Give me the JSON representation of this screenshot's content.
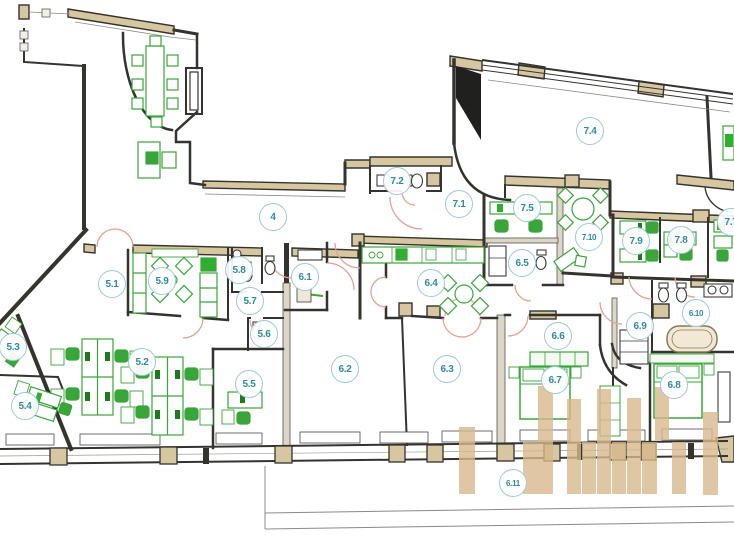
{
  "plan": {
    "kind": "architectural floor plan",
    "room_labels": [
      {
        "label": "4",
        "x": 273,
        "y": 217
      },
      {
        "label": "5.1",
        "x": 112,
        "y": 284
      },
      {
        "label": "5.2",
        "x": 142,
        "y": 362
      },
      {
        "label": "5.3",
        "x": 13,
        "y": 347
      },
      {
        "label": "5.4",
        "x": 25,
        "y": 406
      },
      {
        "label": "5.5",
        "x": 249,
        "y": 384
      },
      {
        "label": "5.6",
        "x": 264,
        "y": 334
      },
      {
        "label": "5.7",
        "x": 250,
        "y": 301
      },
      {
        "label": "5.8",
        "x": 239,
        "y": 270
      },
      {
        "label": "5.9",
        "x": 162,
        "y": 281
      },
      {
        "label": "6.1",
        "x": 305,
        "y": 277
      },
      {
        "label": "6.2",
        "x": 345,
        "y": 369
      },
      {
        "label": "6.3",
        "x": 447,
        "y": 369
      },
      {
        "label": "6.4",
        "x": 431,
        "y": 283
      },
      {
        "label": "6.5",
        "x": 522,
        "y": 263
      },
      {
        "label": "6.6",
        "x": 558,
        "y": 336
      },
      {
        "label": "6.7",
        "x": 555,
        "y": 380
      },
      {
        "label": "6.8",
        "x": 674,
        "y": 385
      },
      {
        "label": "6.9",
        "x": 640,
        "y": 326
      },
      {
        "label": "6.10",
        "x": 696,
        "y": 313
      },
      {
        "label": "6.11",
        "x": 513,
        "y": 483
      },
      {
        "label": "7.1",
        "x": 459,
        "y": 204
      },
      {
        "label": "7.2",
        "x": 397,
        "y": 181
      },
      {
        "label": "7.4",
        "x": 590,
        "y": 131
      },
      {
        "label": "7.5",
        "x": 527,
        "y": 208
      },
      {
        "label": "7.7",
        "x": 731,
        "y": 222
      },
      {
        "label": "7.8",
        "x": 681,
        "y": 240
      },
      {
        "label": "7.9",
        "x": 636,
        "y": 241
      },
      {
        "label": "7.10",
        "x": 589,
        "y": 237
      }
    ],
    "colors": {
      "wall": "#34332e",
      "structure_tan": "#d7c7a0",
      "hatch_fill": "#dcd6c8",
      "furniture_green": "#3aa53a",
      "furniture_green_bright": "#2fae2f",
      "furniture_fill": "#f4faf1",
      "door_arc_salmon": "#e8a091",
      "label_text_teal": "#2f8ba1",
      "label_circle_border": "#9ccad7",
      "window_line": "#8a8a82",
      "watermark_bar_tan": "#d9b88c",
      "shaft_black": "#20201e",
      "bathtub_outline": "#8a7a55"
    }
  }
}
